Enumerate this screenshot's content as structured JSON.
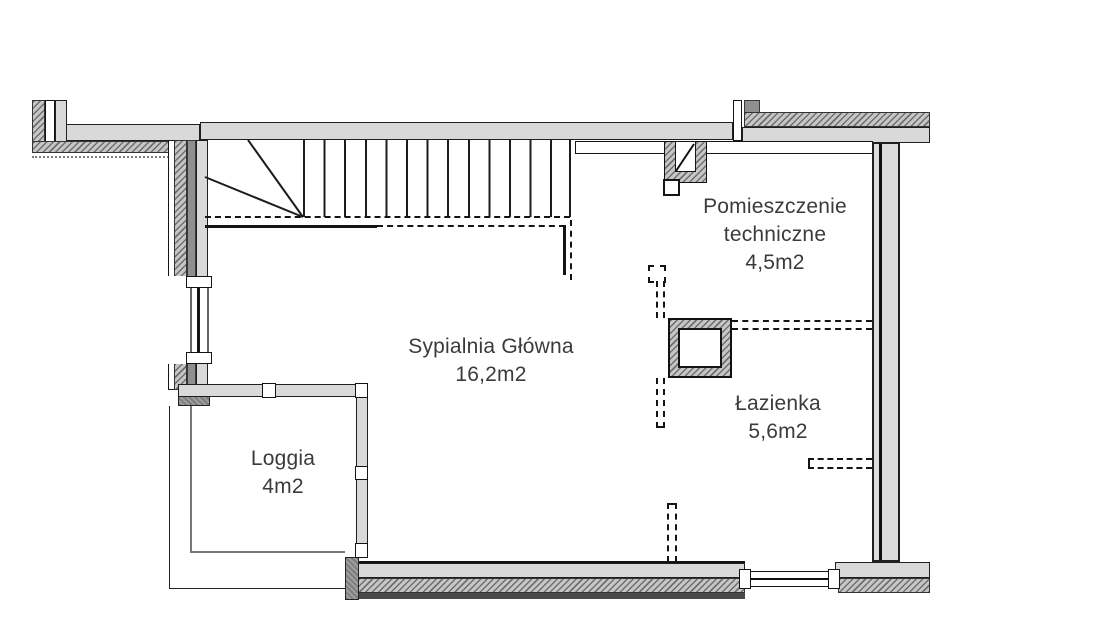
{
  "plan_title": "Floor plan",
  "rooms": {
    "bedroom": {
      "name": "Sypialnia Główna",
      "area": "16,2m2"
    },
    "technical": {
      "name_line1": "Pomieszczenie",
      "name_line2": "techniczne",
      "area": "4,5m2"
    },
    "bathroom": {
      "name": "Łazienka",
      "area": "5,6m2"
    },
    "loggia": {
      "name": "Loggia",
      "area": "4m2"
    }
  },
  "colors": {
    "wall_fill": "#d9d9d9",
    "wall_line": "#1f1f1f",
    "hatch_dark": "#6f6f6f",
    "dark_block": "#8f8f8f",
    "label_text": "#3b3b3b",
    "background": "#ffffff"
  }
}
